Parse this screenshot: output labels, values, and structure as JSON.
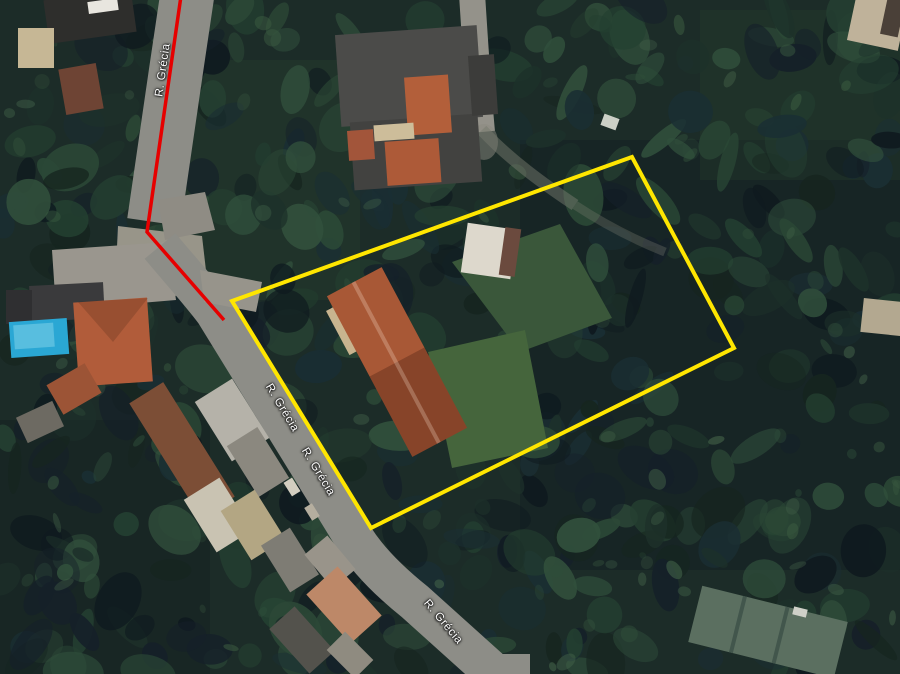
{
  "map": {
    "view": "satellite",
    "street_name": "R. Grécia",
    "labels": [
      {
        "text": "R. Grécia"
      },
      {
        "text": "R. Grécia"
      },
      {
        "text": "R. Grécia"
      },
      {
        "text": "R. Grécia"
      }
    ],
    "overlays": {
      "property_boundary_color": "#ffe600",
      "route_color": "#e60000"
    },
    "features": {
      "road_color": "#8d8d87",
      "pool_color": "#2aa7d4",
      "roof_terracotta": "#a85836",
      "lawn_color": "#45653c",
      "forest_palette": [
        "#16251f",
        "#1d312a",
        "#244031",
        "#152029",
        "#2b4836",
        "#1a2e33",
        "#31503c",
        "#0f1a1f"
      ],
      "forest_highlight_palette": [
        "#3a5a40",
        "#2f4e3a",
        "#44644a"
      ]
    }
  }
}
